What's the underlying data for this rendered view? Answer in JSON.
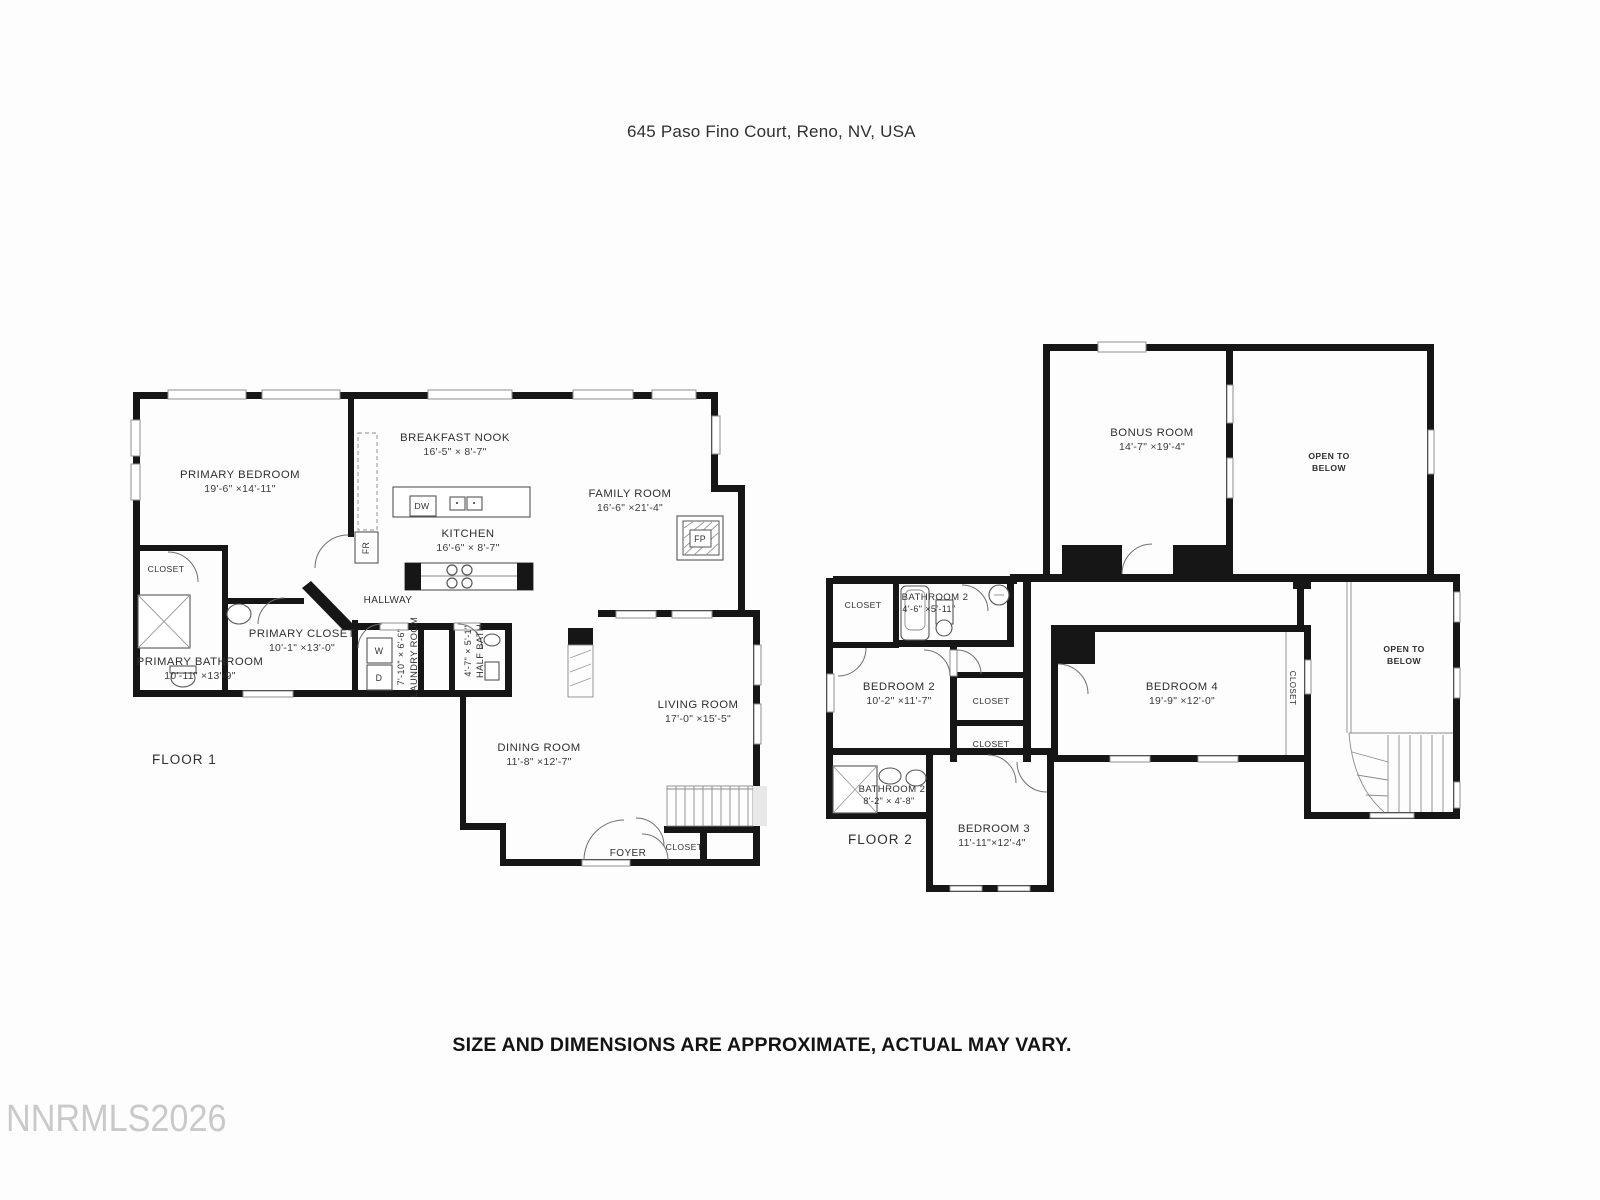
{
  "page": {
    "title": "645 Paso Fino Court, Reno, NV, USA",
    "disclaimer": "SIZE AND DIMENSIONS ARE APPROXIMATE, ACTUAL MAY VARY.",
    "watermark": "NNRMLS2026"
  },
  "labels": {
    "closet": "CLOSET",
    "hallway": "HALLWAY",
    "foyer": "FOYER",
    "open_to_below_line1": "OPEN TO",
    "open_to_below_line2": "BELOW"
  },
  "fixtures": {
    "dishwasher": "DW",
    "fridge": "FR",
    "fireplace": "FP",
    "washer": "W",
    "dryer": "D"
  },
  "floor1": {
    "label": "FLOOR 1",
    "rooms": {
      "primary_bedroom": {
        "name": "PRIMARY BEDROOM",
        "dims": "19'-6\" ×14'-11\""
      },
      "breakfast_nook": {
        "name": "BREAKFAST NOOK",
        "dims": "16'-5\" × 8'-7\""
      },
      "family_room": {
        "name": "FAMILY ROOM",
        "dims": "16'-6\" ×21'-4\""
      },
      "kitchen": {
        "name": "KITCHEN",
        "dims": "16'-6\" × 8'-7\""
      },
      "primary_closet": {
        "name": "PRIMARY CLOSET",
        "dims": "10'-1\" ×13'-0\""
      },
      "primary_bathroom": {
        "name": "PRIMARY BATHROOM",
        "dims": "10'-11\" ×13'-9\""
      },
      "laundry_room": {
        "name": "LAUNDRY ROOM",
        "dims": "7'-10\" × 6'-6\""
      },
      "half_bath": {
        "name": "HALF BATH",
        "dims": "4'-7\" × 5'-1\""
      },
      "living_room": {
        "name": "LIVING ROOM",
        "dims": "17'-0\" ×15'-5\""
      },
      "dining_room": {
        "name": "DINING ROOM",
        "dims": "11'-8\" ×12'-7\""
      }
    }
  },
  "floor2": {
    "label": "FLOOR 2",
    "rooms": {
      "bonus_room": {
        "name": "BONUS ROOM",
        "dims": "14'-7\" ×19'-4\""
      },
      "bathroom_2": {
        "name": "BATHROOM 2",
        "dims": "4'-6\" ×5'-11\""
      },
      "bedroom_2": {
        "name": "BEDROOM 2",
        "dims": "10'-2\" ×11'-7\""
      },
      "bedroom_4": {
        "name": "BEDROOM 4",
        "dims": "19'-9\" ×12'-0\""
      },
      "bathroom_2b": {
        "name": "BATHROOM 2",
        "dims": "8'-2\" × 4'-8\""
      },
      "bedroom_3": {
        "name": "BEDROOM 3",
        "dims": "11'-11\"×12'-4\""
      }
    }
  }
}
